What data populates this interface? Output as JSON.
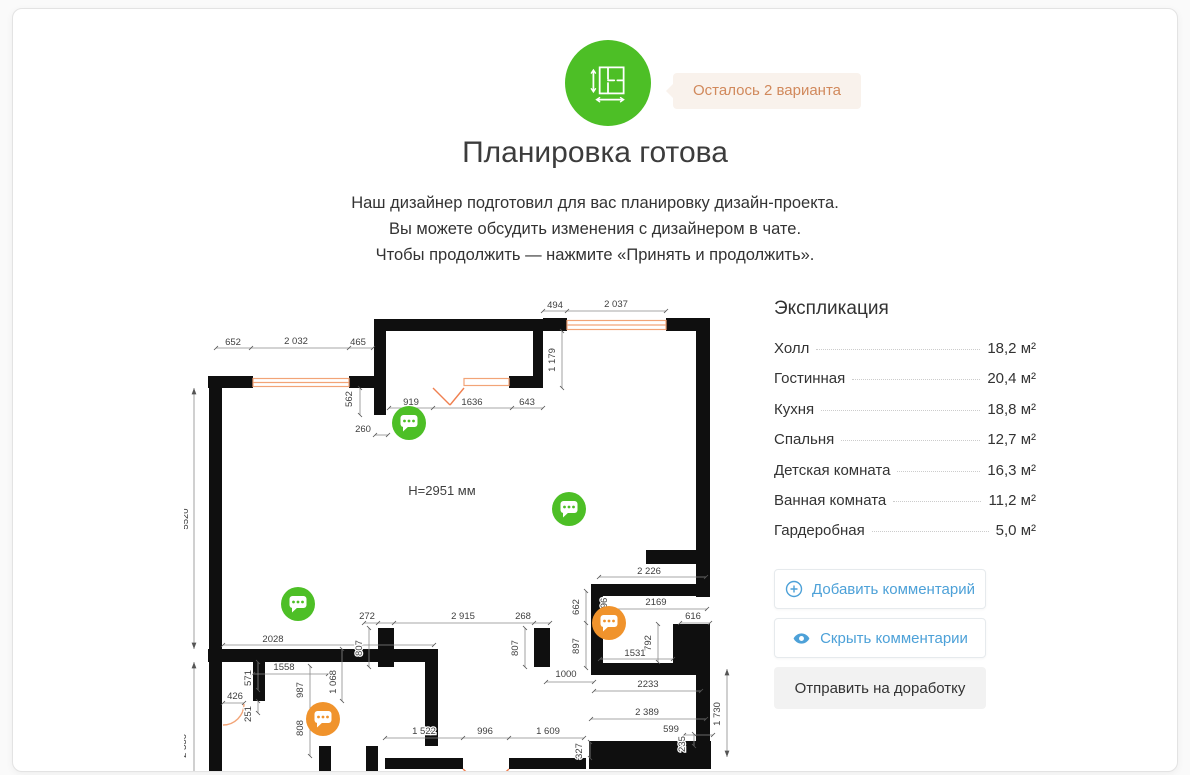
{
  "colors": {
    "green": "#4dbf26",
    "orange_marker": "#f0932c",
    "badge_bg": "#f9f2ec",
    "badge_text": "#d1895c",
    "blue": "#4da1d8",
    "wall": "#0f0f0f",
    "window_orange": "#f2a477",
    "door_orange": "#f08050"
  },
  "header": {
    "badge": "Осталось 2 варианта"
  },
  "title": "Планировка готова",
  "subtitle": {
    "line1": "Наш дизайнер подготовил для вас планировку дизайн-проекта.",
    "line2": "Вы можете обсудить изменения с дизайнером в чате.",
    "line3": "Чтобы продолжить — нажмите «Принять и продолжить»."
  },
  "plan": {
    "height_label": "H=2951 мм",
    "dims": {
      "d652": "652",
      "d2032": "2 032",
      "d465": "465",
      "d494": "494",
      "d2037": "2 037",
      "d562": "562",
      "d1179": "1 179",
      "d919": "919",
      "d1636": "1636",
      "d643": "643",
      "d260": "260",
      "d5520": "5520",
      "d2336": "2 336",
      "d2028": "2028",
      "d1558": "1558",
      "d571": "571",
      "d426": "426",
      "d251": "251",
      "d987": "987",
      "d1068": "1 068",
      "d808": "808",
      "d272": "272",
      "d2915": "2 915",
      "d268": "268",
      "d807a": "807",
      "d807b": "807",
      "d1522": "1 522",
      "d996": "996",
      "d1609": "1 609",
      "d2226": "2 226",
      "d662": "662",
      "d2169": "2169",
      "d96": "96",
      "d616": "616",
      "d897": "897",
      "d792": "792",
      "d1531": "1531",
      "d1000": "1000",
      "d2233": "2233",
      "d2389": "2 389",
      "d599": "599",
      "d1730": "1 730",
      "d327": "327",
      "d235": "235"
    }
  },
  "explication": {
    "title": "Экспликация",
    "rows": [
      {
        "label": "Холл",
        "value": "18,2 м²"
      },
      {
        "label": "Гостинная",
        "value": "20,4 м²"
      },
      {
        "label": "Кухня",
        "value": "18,8 м²"
      },
      {
        "label": "Спальня",
        "value": "12,7 м²"
      },
      {
        "label": "Детская комната",
        "value": "16,3 м²"
      },
      {
        "label": "Ванная комната",
        "value": "11,2 м²"
      },
      {
        "label": "Гардеробная",
        "value": "5,0 м²"
      }
    ]
  },
  "actions": {
    "add_comment": "Добавить комментарий",
    "hide_comments": "Скрыть комментарии",
    "send_revision": "Отправить на доработку"
  }
}
